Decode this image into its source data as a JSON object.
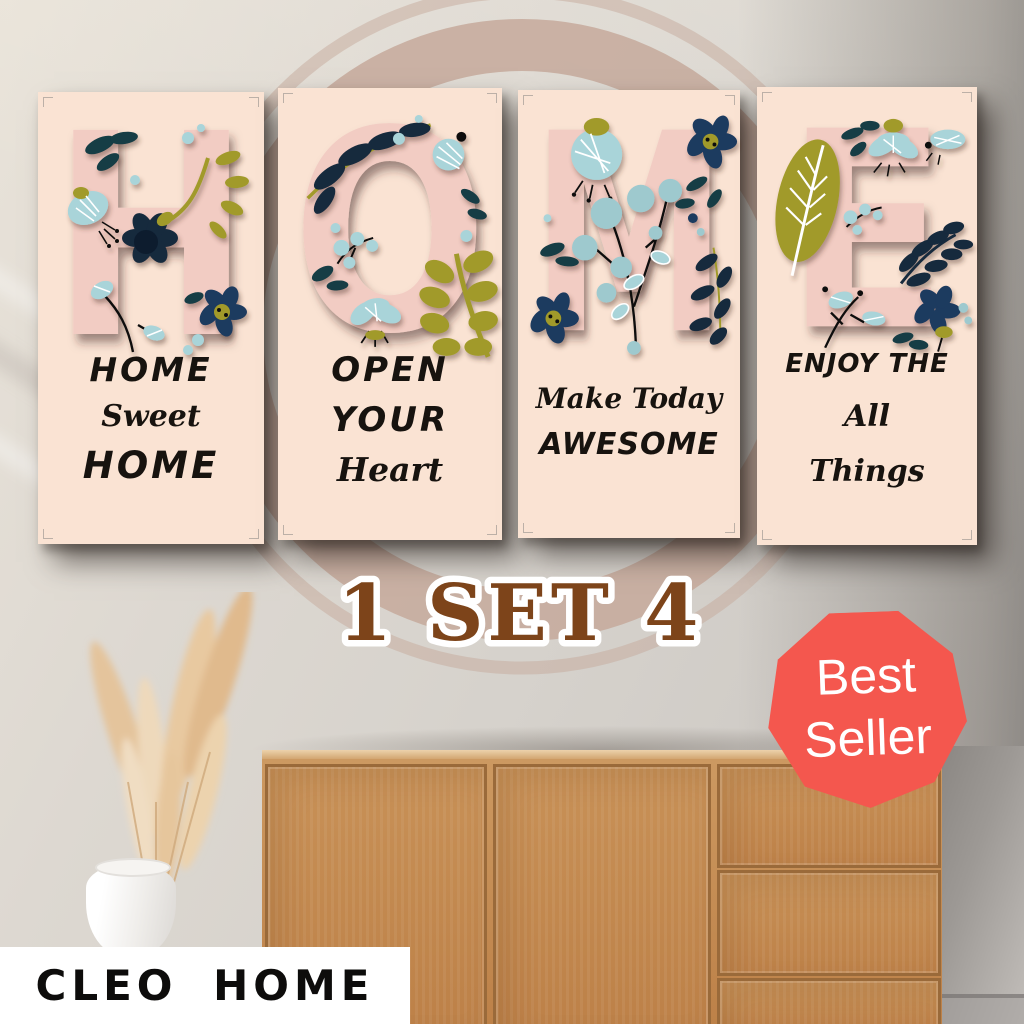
{
  "scene": {
    "set_label": "1 SET 4",
    "brand": "CLEO HOME",
    "badge": {
      "line1": "Best",
      "line2": "Seller"
    },
    "panels": [
      {
        "letter": "H",
        "lines": [
          "HOME",
          "Sweet",
          "HOME"
        ]
      },
      {
        "letter": "O",
        "lines": [
          "OPEN",
          "YOUR",
          "Heart"
        ]
      },
      {
        "letter": "M",
        "lines": [
          "Make Today",
          "AWESOME"
        ]
      },
      {
        "letter": "E",
        "lines": [
          "ENJOY THE",
          "All",
          "Things"
        ]
      }
    ],
    "palette": {
      "panel_background": "#fae3d3",
      "letter_pink": "#f2ccc3",
      "floral_navy": "#14293d",
      "floral_teal": "#123c44",
      "floral_light_blue": "#a9d4d9",
      "floral_olive": "#a19a2b",
      "quote_text": "#17130f",
      "set_label_brown": "#7d441a",
      "badge_red": "#f4574e",
      "wall_ring_tan": "#c6a99b",
      "cabinet_wood": "#c18a52"
    }
  }
}
